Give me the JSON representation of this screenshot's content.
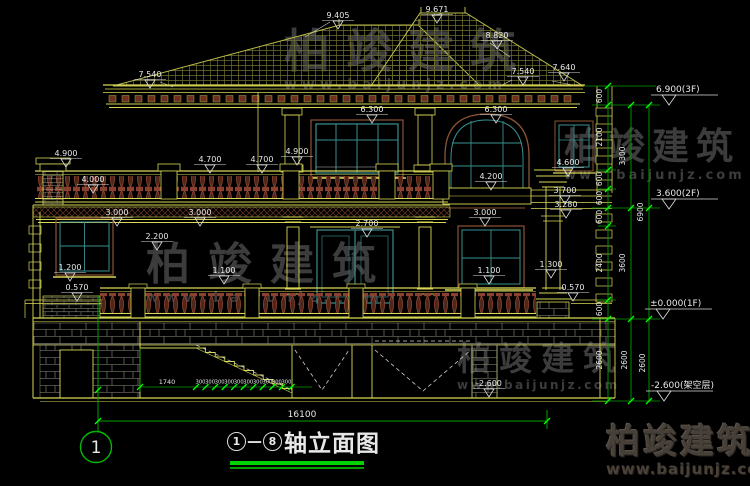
{
  "watermark": {
    "brand": "柏竣建筑",
    "url": "www.baijunjz.com"
  },
  "brand_footer": {
    "name": "柏竣建筑",
    "url": "www.baijunjz.com"
  },
  "title_block": {
    "axis_start": "1",
    "axis_end": "8",
    "separator": "—",
    "title": "轴立面图"
  },
  "axis_bubble": {
    "label": "1"
  },
  "elevation_levels": [
    {
      "t": "6.900(3F)",
      "x": 656,
      "y": 92
    },
    {
      "t": "3.600(2F)",
      "x": 656,
      "y": 196
    },
    {
      "t": "±0.000(1F)",
      "x": 650,
      "y": 306
    },
    {
      "t": "-2.600(架空层)",
      "x": 651,
      "y": 388
    }
  ],
  "dimensions": [
    {
      "t": "9.405",
      "x": 338,
      "y": 18
    },
    {
      "t": "9.671",
      "x": 437,
      "y": 12
    },
    {
      "t": "8.820",
      "x": 497,
      "y": 38
    },
    {
      "t": "7.540",
      "x": 150,
      "y": 77
    },
    {
      "t": "7.540",
      "x": 523,
      "y": 74
    },
    {
      "t": "7.640",
      "x": 564,
      "y": 70
    },
    {
      "t": "6.300",
      "x": 372,
      "y": 112
    },
    {
      "t": "6.300",
      "x": 496,
      "y": 112
    },
    {
      "t": "4.900",
      "x": 66,
      "y": 156
    },
    {
      "t": "4.700",
      "x": 210,
      "y": 162
    },
    {
      "t": "4.700",
      "x": 262,
      "y": 162
    },
    {
      "t": "4.900",
      "x": 297,
      "y": 154
    },
    {
      "t": "4.000",
      "x": 93,
      "y": 182
    },
    {
      "t": "4.600",
      "x": 568,
      "y": 165
    },
    {
      "t": "4.200",
      "x": 491,
      "y": 179
    },
    {
      "t": "3.700",
      "x": 565,
      "y": 193
    },
    {
      "t": "3.280",
      "x": 566,
      "y": 207
    },
    {
      "t": "3.000",
      "x": 117,
      "y": 215
    },
    {
      "t": "3.000",
      "x": 200,
      "y": 215
    },
    {
      "t": "3.000",
      "x": 485,
      "y": 215
    },
    {
      "t": "2.700",
      "x": 367,
      "y": 226
    },
    {
      "t": "2.200",
      "x": 157,
      "y": 239
    },
    {
      "t": "1.200",
      "x": 70,
      "y": 270
    },
    {
      "t": "1.100",
      "x": 224,
      "y": 273
    },
    {
      "t": "1.100",
      "x": 489,
      "y": 273
    },
    {
      "t": "1.300",
      "x": 551,
      "y": 267
    },
    {
      "t": "0.570",
      "x": 77,
      "y": 290
    },
    {
      "t": "0.570",
      "x": 573,
      "y": 290
    },
    {
      "t": "-2.600",
      "x": 489,
      "y": 386
    },
    {
      "t": "1740",
      "x": 167,
      "y": 384,
      "plain": true,
      "s": 6.5
    },
    {
      "t": "16100",
      "x": 302,
      "y": 417,
      "plain": true,
      "s": 9
    }
  ],
  "chain_dims": [
    {
      "t": "600",
      "x": 602,
      "y": 96
    },
    {
      "t": "2100",
      "x": 602,
      "y": 137
    },
    {
      "t": "600",
      "x": 602,
      "y": 179
    },
    {
      "t": "600",
      "x": 602,
      "y": 198
    },
    {
      "t": "600",
      "x": 602,
      "y": 217
    },
    {
      "t": "2400",
      "x": 602,
      "y": 263
    },
    {
      "t": "600",
      "x": 602,
      "y": 309
    },
    {
      "t": "2600",
      "x": 602,
      "y": 360
    },
    {
      "t": "3300",
      "x": 625,
      "y": 156
    },
    {
      "t": "3600",
      "x": 625,
      "y": 263
    },
    {
      "t": "2600",
      "x": 627,
      "y": 360
    },
    {
      "t": "6900",
      "x": 643,
      "y": 212
    },
    {
      "t": "2600",
      "x": 645,
      "y": 363
    }
  ],
  "stair_dims": {
    "landing": "1740",
    "tread": "300",
    "tread_count": 10,
    "total_width": "16100"
  }
}
